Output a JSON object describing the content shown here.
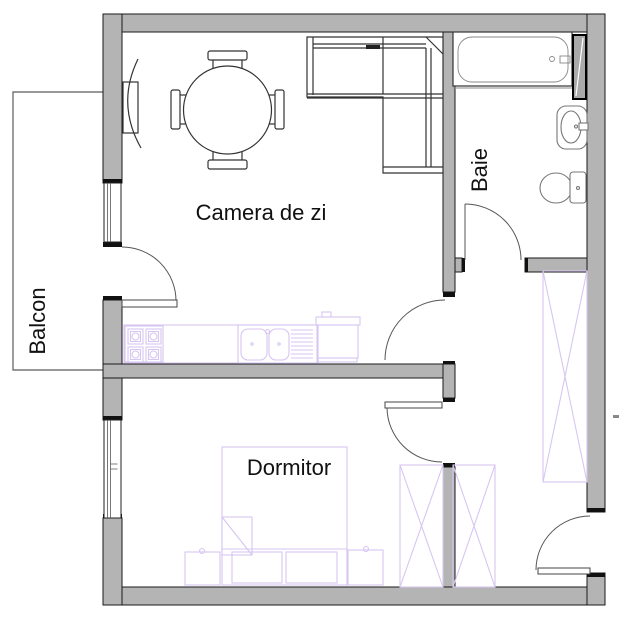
{
  "plan": {
    "type": "apartment-floor-plan",
    "rooms": {
      "balcony": {
        "label": "Balcon",
        "orientation": "vertical"
      },
      "living": {
        "label": "Camera de zi",
        "orientation": "horizontal"
      },
      "bathroom": {
        "label": "Baie",
        "orientation": "vertical"
      },
      "bedroom": {
        "label": "Dormitor",
        "orientation": "horizontal"
      }
    },
    "colors": {
      "wall_fill": "#b4b4b4",
      "wall_edge": "#1a1a1a",
      "furniture_line": "#333333",
      "sanitary_line": "#777777",
      "kitchen_bed_wardrobe_line": "#d7c6f2",
      "door_arc": "#555555",
      "text": "#111111",
      "background": "#ffffff"
    },
    "fixtures": [
      "dining-table",
      "dining-chair",
      "corner-sofa",
      "curtain-radiator",
      "bathtub",
      "shower-screen",
      "washbasin",
      "toilet",
      "kitchen-counter",
      "cooktop",
      "kitchen-sink",
      "washing-machine",
      "bed",
      "nightstand",
      "wardrobe",
      "interior-door",
      "balcony-door",
      "bathroom-door",
      "bedroom-door",
      "entrance-door",
      "window",
      "balcony-railing"
    ]
  }
}
